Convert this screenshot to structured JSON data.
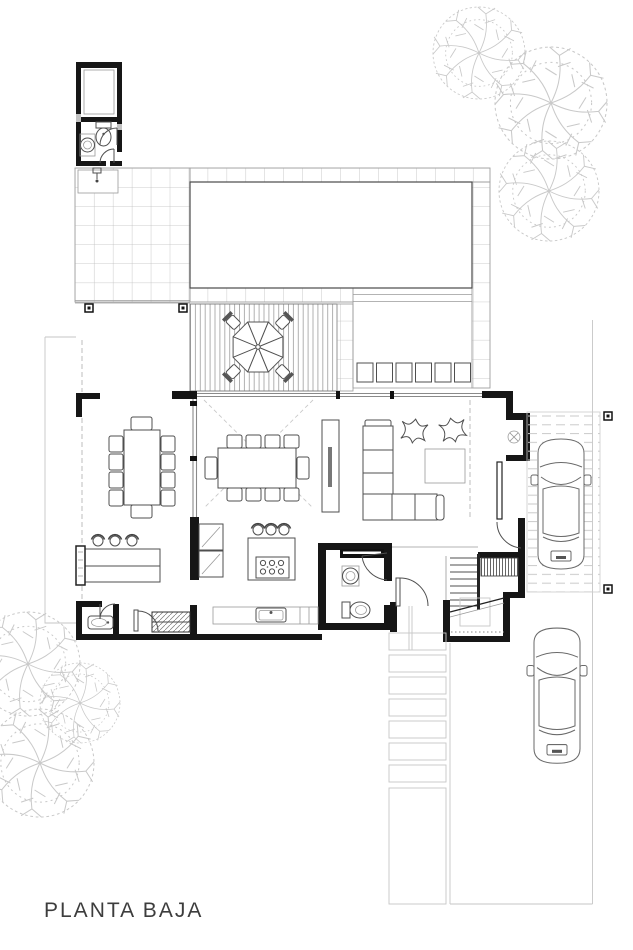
{
  "title": {
    "label": "PLANTA BAJA"
  },
  "colors": {
    "background": "#ffffff",
    "walls": "#161616",
    "furniture_line": "#4f4f4f",
    "light_line": "#9a9a9a",
    "faint_line": "#c6c6c6",
    "tile_line": "#bcbcbc",
    "tree_line": "#c9c9c9",
    "text": "#3d3d3d"
  },
  "plan": {
    "type": "architectural-floor-plan",
    "floor_label": "PLANTA BAJA",
    "objects": [
      {
        "name": "swimming-pool",
        "qty": 1
      },
      {
        "name": "tiled-patio",
        "qty": 1
      },
      {
        "name": "wood-deck",
        "qty": 1
      },
      {
        "name": "patio-umbrella",
        "qty": 1,
        "chairs": 4
      },
      {
        "name": "sun-lounger",
        "qty": 6
      },
      {
        "name": "outdoor-wc-annex",
        "qty": 1
      },
      {
        "name": "outdoor-sink-counter",
        "qty": 1
      },
      {
        "name": "terrace-dining-table",
        "qty": 1,
        "chairs": 10
      },
      {
        "name": "indoor-dining-table",
        "qty": 1,
        "chairs": 10
      },
      {
        "name": "bar-counter",
        "qty": 1,
        "stools": 3
      },
      {
        "name": "kitchen-island-cooktop",
        "qty": 1,
        "stools": 3,
        "burners": 6
      },
      {
        "name": "refrigerator",
        "qty": 1
      },
      {
        "name": "kitchen-sink-counter",
        "qty": 1
      },
      {
        "name": "washing-machine",
        "qty": 1
      },
      {
        "name": "guest-bathroom-sink",
        "qty": 1
      },
      {
        "name": "powder-room-toilet",
        "qty": 1
      },
      {
        "name": "powder-room-sink",
        "qty": 1
      },
      {
        "name": "l-shaped-sofa",
        "qty": 1
      },
      {
        "name": "tv-console",
        "qty": 1
      },
      {
        "name": "coffee-table",
        "qty": 1
      },
      {
        "name": "pouf",
        "qty": 2
      },
      {
        "name": "entry-closet",
        "qty": 1
      },
      {
        "name": "staircase",
        "qty": 1
      },
      {
        "name": "carport-car",
        "qty": 1
      },
      {
        "name": "driveway-car",
        "qty": 1
      },
      {
        "name": "paver-walkway",
        "qty": 1
      },
      {
        "name": "tree-canopy-top-right",
        "qty": 3
      },
      {
        "name": "tree-canopy-bottom-left",
        "qty": 3
      }
    ]
  }
}
